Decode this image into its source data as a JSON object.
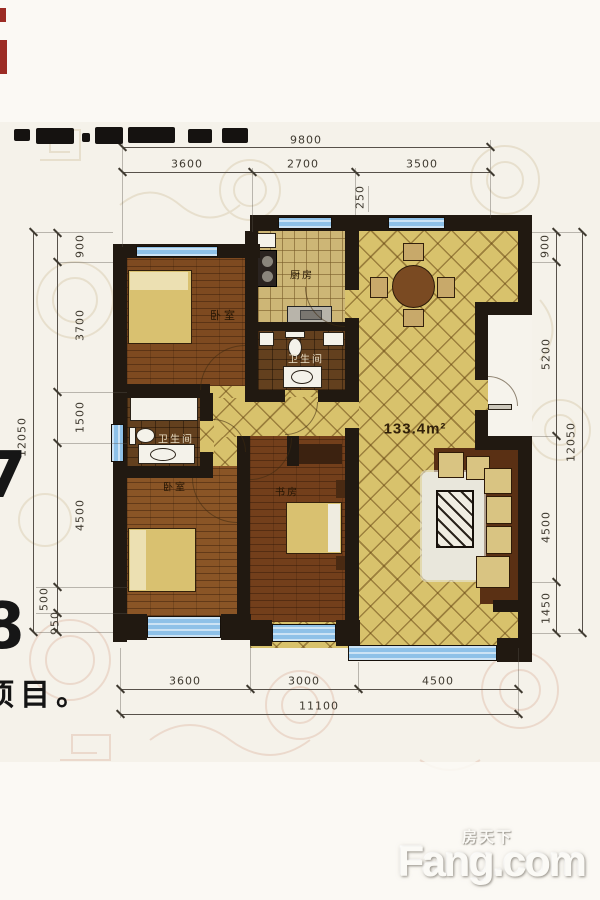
{
  "page": {
    "bottom_left_text": "项目。",
    "left_edge_glyph_1": "7",
    "left_edge_glyph_2": "8",
    "watermark": {
      "cn": "房天下",
      "en": "Fang.com"
    }
  },
  "floorplan": {
    "area": "133.4m²",
    "rooms": {
      "bedroom1": "卧室",
      "bedroom2": "卧室",
      "kitchen": "厨房",
      "bath1": "卫生间",
      "bath2": "卫生间",
      "study": "书房"
    },
    "dims": {
      "top_total": "9800",
      "top": [
        "3600",
        "2700",
        "3500"
      ],
      "wall_offset": "250",
      "left_total": "12050",
      "left": [
        "900",
        "3700",
        "1500",
        "4500",
        "500",
        "950"
      ],
      "right_total": "12050",
      "right": [
        "900",
        "5200",
        "4500",
        "1450"
      ],
      "bottom": [
        "3600",
        "3000",
        "4500"
      ],
      "bottom_total": "11100"
    },
    "palette": {
      "wall_dark": "#211911",
      "window_blue": "#8ec1e8",
      "tile_gold": "#d8c26c",
      "wood_brown": "#7e4a20",
      "bath_tile": "#63401e"
    }
  }
}
